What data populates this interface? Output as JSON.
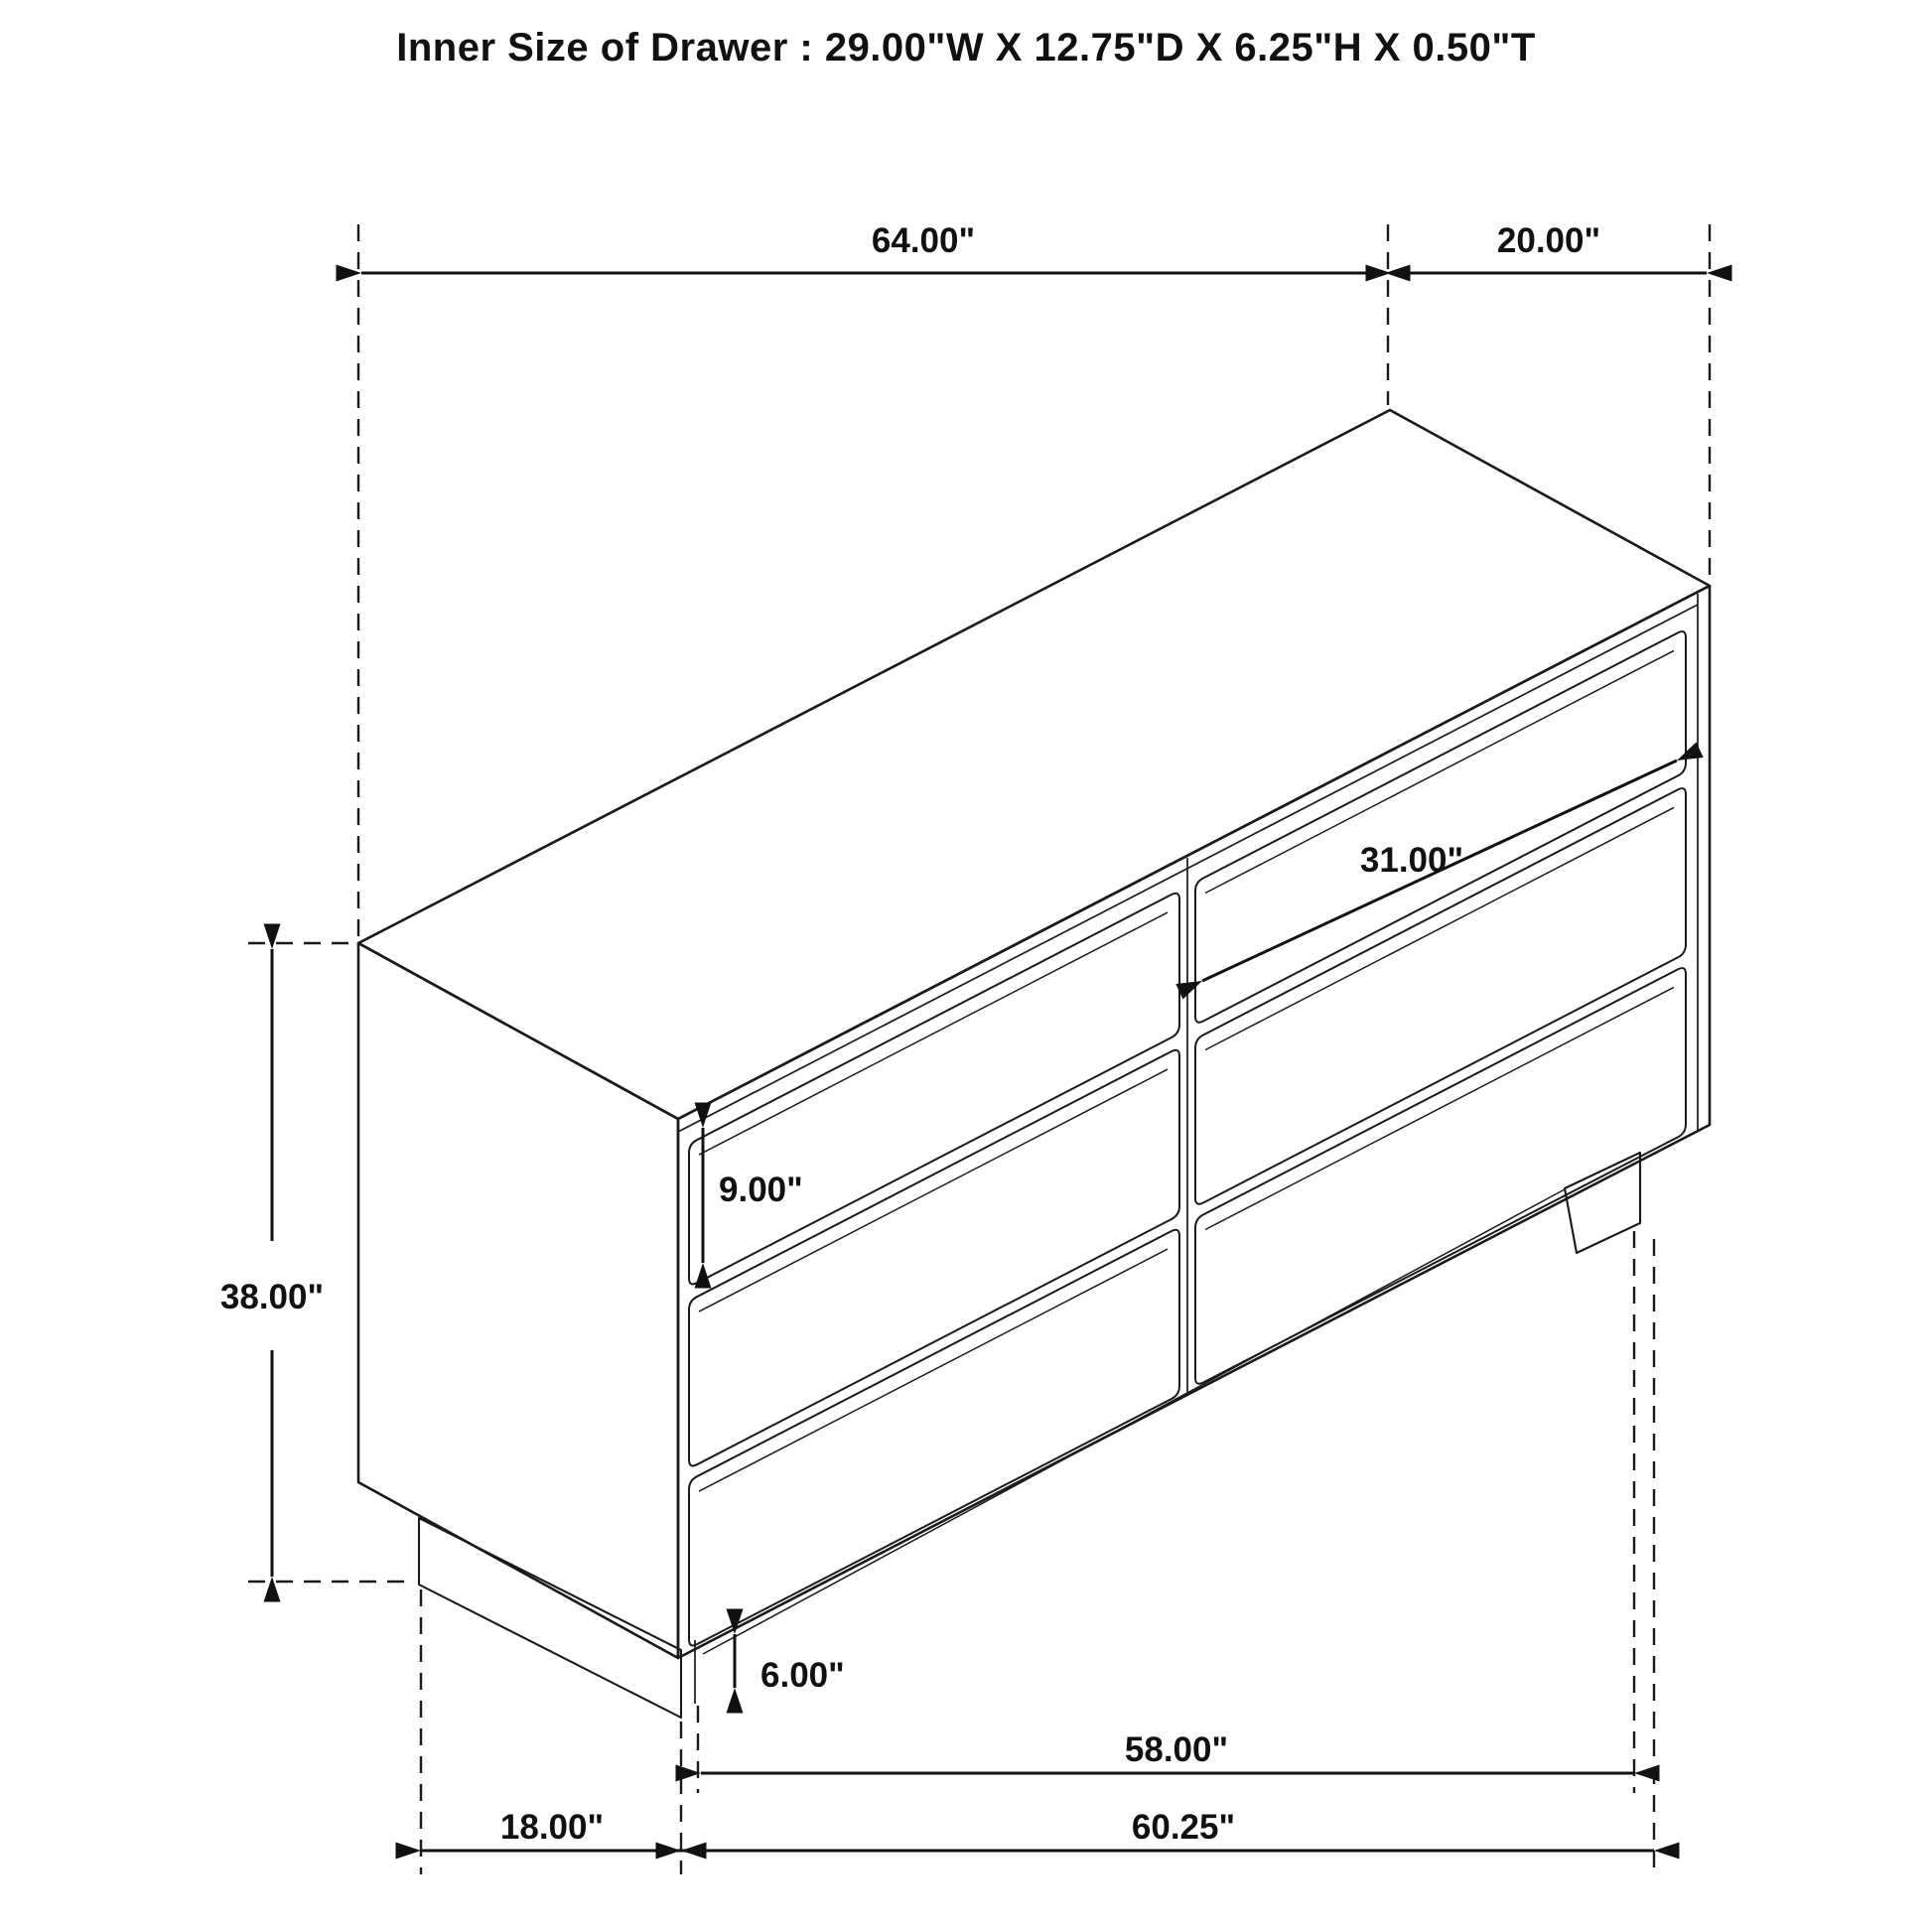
{
  "title": "Inner Size of Drawer : 29.00\"W X 12.75\"D X 6.25\"H X 0.50\"T",
  "dimensions": {
    "overall_width": "64.00\"",
    "overall_depth": "20.00\"",
    "overall_height": "38.00\"",
    "drawer_face_width": "31.00\"",
    "drawer_face_height": "9.00\"",
    "base_height": "6.00\"",
    "base_front_width": "58.00\"",
    "bottom_front_width": "60.25\"",
    "bottom_side_depth": "18.00\""
  },
  "colors": {
    "line": "#1a1a1a",
    "background": "#ffffff",
    "text": "#111111"
  }
}
